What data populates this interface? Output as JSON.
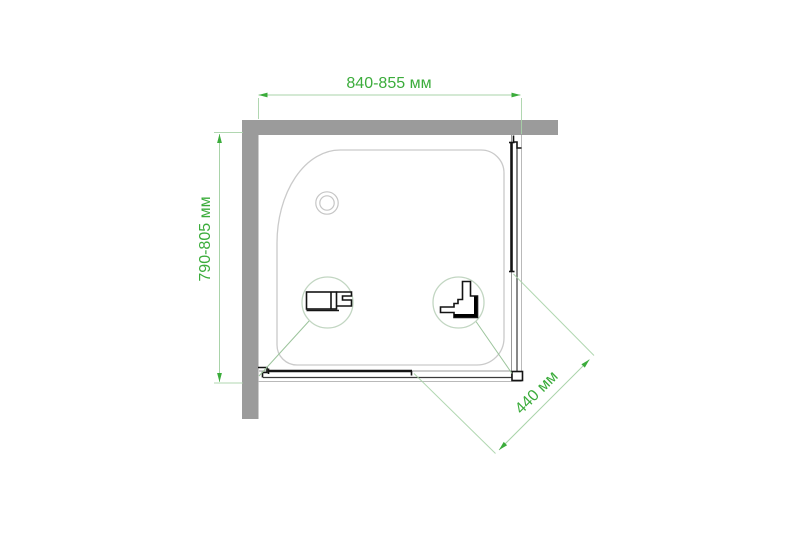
{
  "drawing": {
    "kind": "shower-enclosure-top-view-dimension-drawing"
  },
  "dims": {
    "width": "840-855 мм",
    "depth": "790-805 мм",
    "entry": "440 мм"
  },
  "icons": [
    "wall-profile-section-icon",
    "corner-connector-section-icon",
    "drain-icon"
  ],
  "colors": {
    "c-green": "#3bac3b",
    "c-dimline": "#a9d3a9",
    "c-leader": "#9cc49c",
    "c-circle": "#c2d6c2",
    "c-wall": "#9b9b9b",
    "c-tray": "#cacaca",
    "c-dark": "#141414",
    "c-track": "#999999",
    "c-rail": "#b9b9b9",
    "c-glass": "#3a3a3a",
    "c-bg": "#ffffff"
  }
}
